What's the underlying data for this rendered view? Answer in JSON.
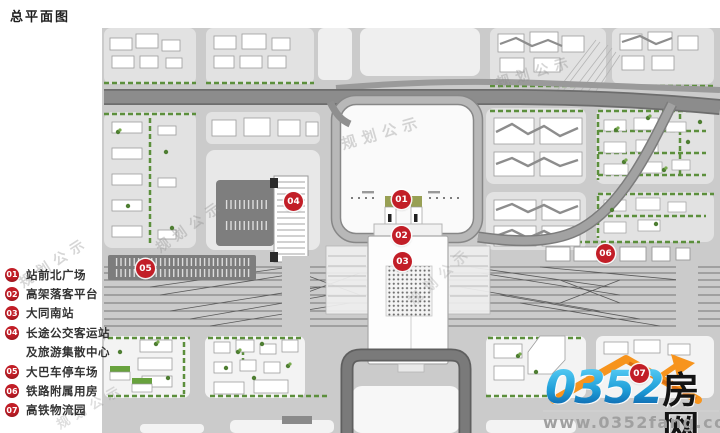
{
  "title": "总平面图",
  "watermark": {
    "text": "规划公示"
  },
  "legend": {
    "items": [
      {
        "num": "01",
        "label": "站前北广场"
      },
      {
        "num": "02",
        "label": "高架落客平台"
      },
      {
        "num": "03",
        "label": "大同南站"
      },
      {
        "num": "04",
        "label": "长途公交客运站",
        "label2": "及旅游集散中心"
      },
      {
        "num": "05",
        "label": "大巴车停车场"
      },
      {
        "num": "06",
        "label": "铁路附属用房"
      },
      {
        "num": "07",
        "label": "高铁物流园"
      }
    ]
  },
  "map": {
    "markers": [
      {
        "label": "01"
      },
      {
        "label": "02"
      },
      {
        "label": "03"
      },
      {
        "label": "04"
      },
      {
        "label": "05"
      },
      {
        "label": "06"
      },
      {
        "label": "07"
      }
    ]
  },
  "logo": {
    "number": "0352",
    "suffix": "房网",
    "url": "www.0352fang.com"
  },
  "icons": {
    "logo_roof": "house-roof-icon",
    "logo_arrow": "up-arrow-icon"
  },
  "colors": {
    "marker_red": "#c21e27",
    "logo_blue": "#1f9ed8",
    "logo_orange": "#f7941d",
    "street_gray": "#cbcbcb",
    "block_gray": "#e2e2e2",
    "green": "#5c8f3c"
  }
}
